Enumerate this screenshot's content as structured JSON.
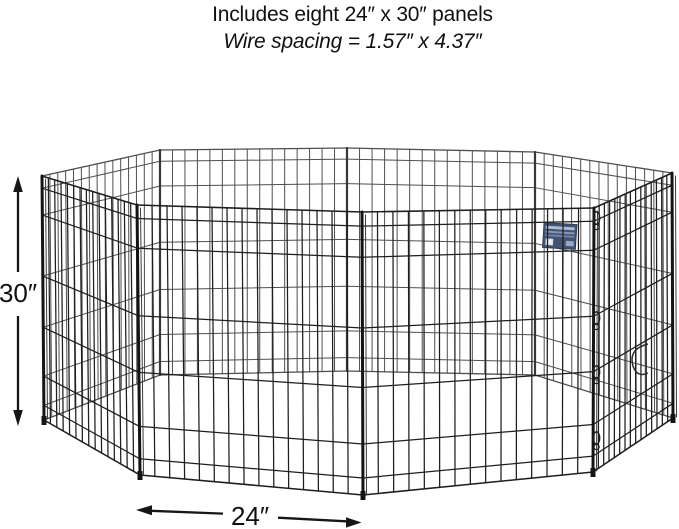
{
  "header": {
    "line1": "Includes eight 24″ x 30″ panels",
    "line2": "Wire spacing = 1.57″ x 4.37″"
  },
  "dimensions": {
    "height_label": "30″",
    "width_label": "24″"
  },
  "illustration": {
    "subject": "black wire octagonal exercise pen with eight hinged panels",
    "panel_count": 8,
    "brand_tag_color": "#43536f",
    "icons": {
      "height_arrow": "vertical-double-arrow-icon",
      "width_arrow": "horizontal-double-arrow-icon",
      "latches": "gate-latch-clip-icon"
    }
  },
  "colors": {
    "background": "#ffffff",
    "text": "#111111",
    "wire_front": "#1e1e1e",
    "wire_back": "#4f4f4f",
    "arrow": "#161616"
  }
}
